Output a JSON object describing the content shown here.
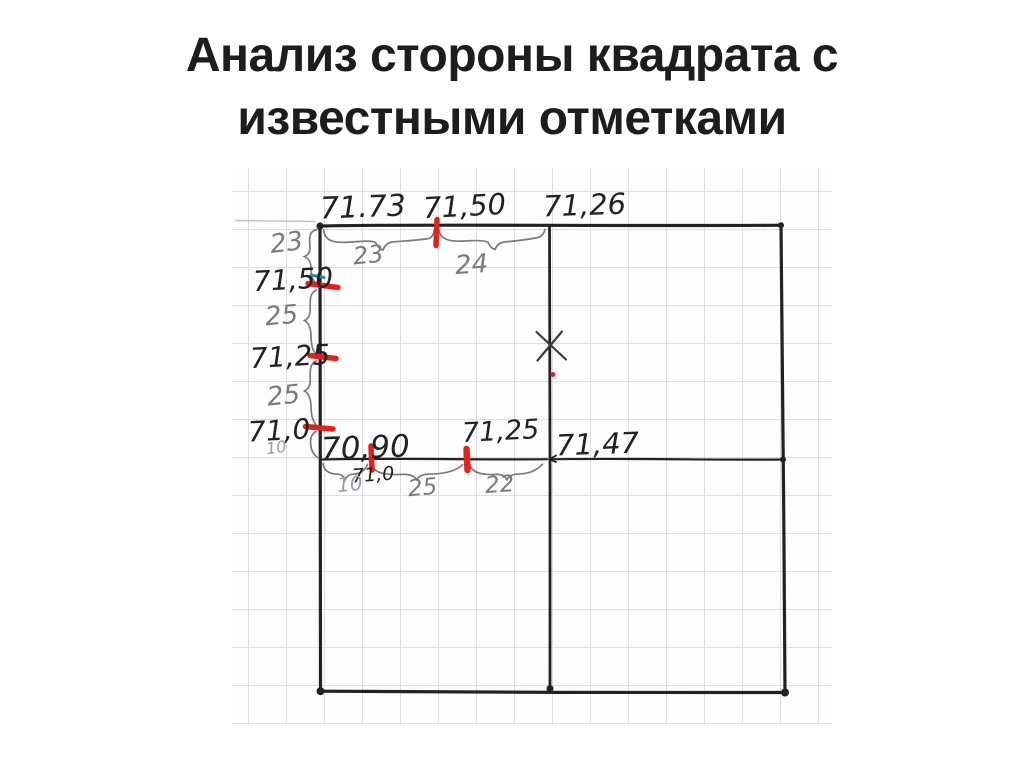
{
  "title": {
    "line1": "Анализ стороны квадрата с",
    "line2": "известными отметками"
  },
  "labels": {
    "top": {
      "e1": "71.73",
      "e2": "71,50",
      "e3": "71,26",
      "d1": "23",
      "d2": "24"
    },
    "left": {
      "d0": "23",
      "e1": "71,50",
      "d1": "25",
      "e2": "71,25",
      "d2": "25",
      "e3": "71,0",
      "d3": "10"
    },
    "mid": {
      "e1": "70,90",
      "e2": "71,0",
      "e3": "71,25",
      "e4": "71,47",
      "d1": "10",
      "d2": "25",
      "d3": "22"
    }
  },
  "colors": {
    "ink": "#222222",
    "pencil": "#7b7b7b",
    "pencil-light": "#9c9ca2",
    "red": "#e0231c",
    "teal": "#2e8f8f",
    "grid": "#dcdde6",
    "title": "#1d1d1d"
  }
}
